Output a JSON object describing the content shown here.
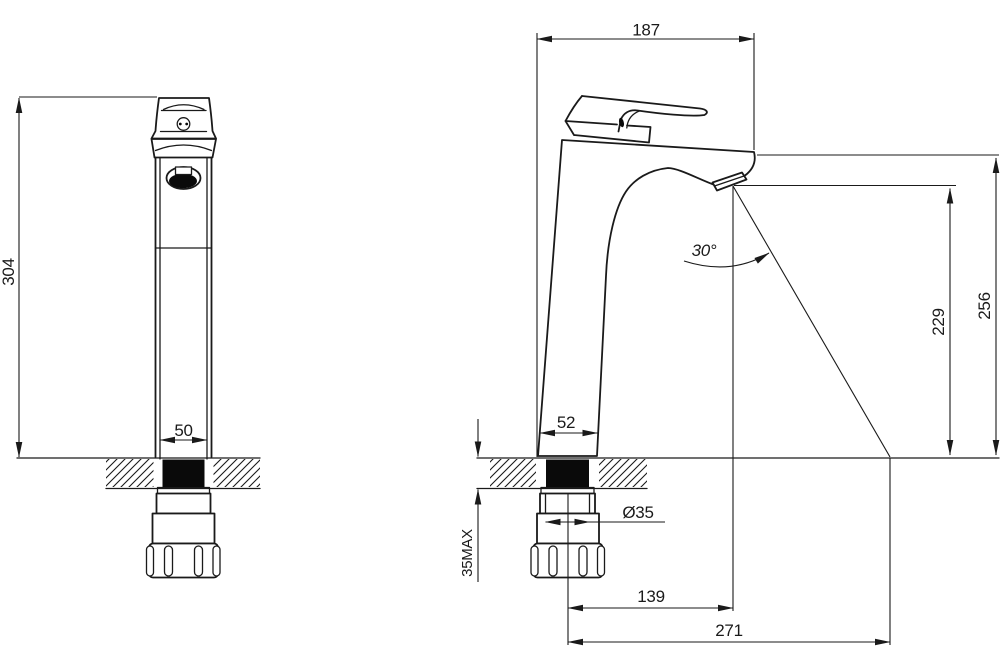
{
  "drawing": {
    "type": "technical-dimension-drawing",
    "subject": "tall single-lever basin faucet, front and side views",
    "colors": {
      "line": "#1a1a1a",
      "background": "#ffffff"
    },
    "front_view": {
      "height": "304",
      "base_width": "50"
    },
    "side_view": {
      "top_width": "187",
      "spout_angle": "30°",
      "spout_height": "229",
      "overall_height": "256",
      "base_width": "52",
      "hole_diameter": "Ø35",
      "max_deck_thickness": "35MAX",
      "spout_reach": "139",
      "stream_reach": "271"
    }
  }
}
